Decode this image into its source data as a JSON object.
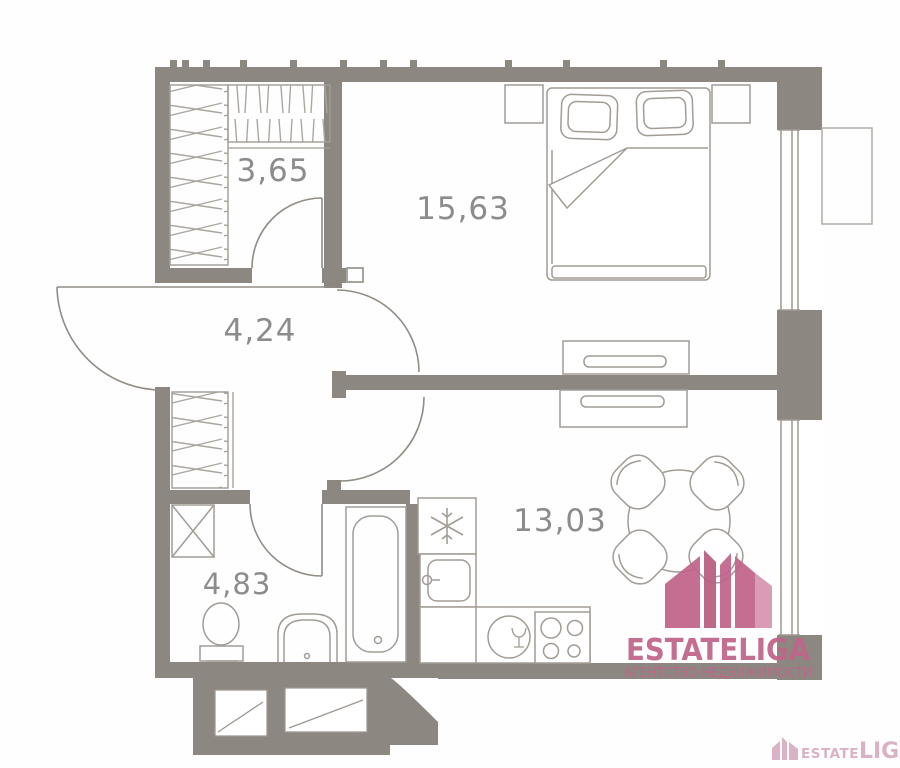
{
  "plan": {
    "rooms": {
      "closet": {
        "area": "3,65"
      },
      "bedroom": {
        "area": "15,63"
      },
      "hallway": {
        "area": "4,24"
      },
      "bathroom": {
        "area": "4,83"
      },
      "kitchen": {
        "area": "13,03"
      }
    }
  },
  "logo": {
    "name": "ESTATELIGA",
    "tagline": "АГЕНТСТВО НЕДВИЖИМОСТИ"
  },
  "watermark": {
    "part1": "ESTATE",
    "part2": "LIGA"
  },
  "colors": {
    "wall": "#8d8781",
    "line": "#9d9890",
    "furniture": "#a19c95",
    "hatch": "#aba69f",
    "label": "#8c8c8c",
    "brand_pink": "#c0658a",
    "brand_pink_light": "#d795b1",
    "watermark_pink": "#d9b3c5"
  }
}
